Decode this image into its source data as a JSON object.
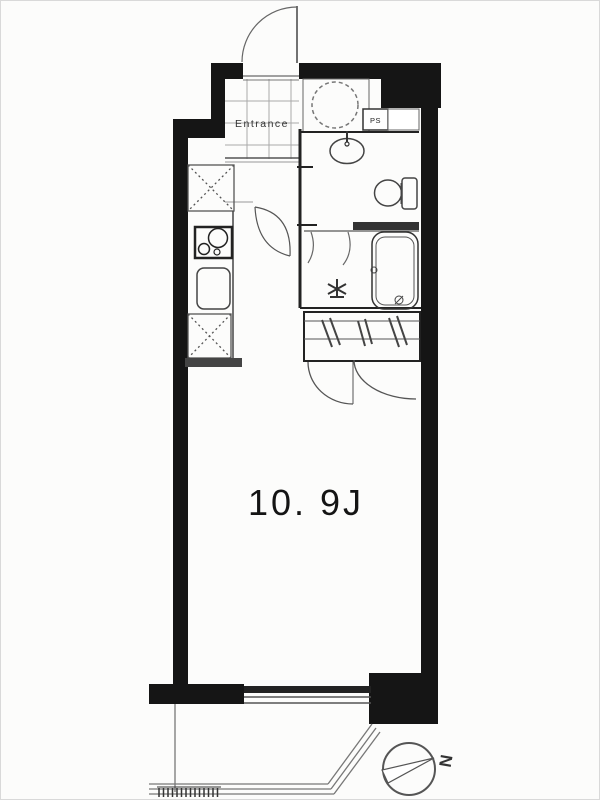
{
  "plan": {
    "type": "apartment-floor-plan",
    "labels": {
      "entrance": "Entrance",
      "pipe_space": "PS",
      "room_area": "10. 9J",
      "compass_north": "N"
    },
    "rooms": [
      {
        "name": "entrance",
        "label": "Entrance"
      },
      {
        "name": "main-room",
        "label": "10. 9J"
      },
      {
        "name": "pipe-space",
        "label": "PS"
      }
    ],
    "fixtures": [
      "entrance-door",
      "washing-machine",
      "washbasin",
      "toilet",
      "bathtub",
      "shower-mixer-tap",
      "floor-drain",
      "refrigerator-space",
      "stove",
      "kitchen-sink",
      "storage-space",
      "closet-with-hangers",
      "closet-doors",
      "sliding-window",
      "balcony",
      "balcony-partition",
      "north-compass"
    ],
    "colors": {
      "wall": "#151515",
      "fixture_line": "#444444",
      "light_line": "#888888",
      "background": "#fcfcfb"
    }
  }
}
